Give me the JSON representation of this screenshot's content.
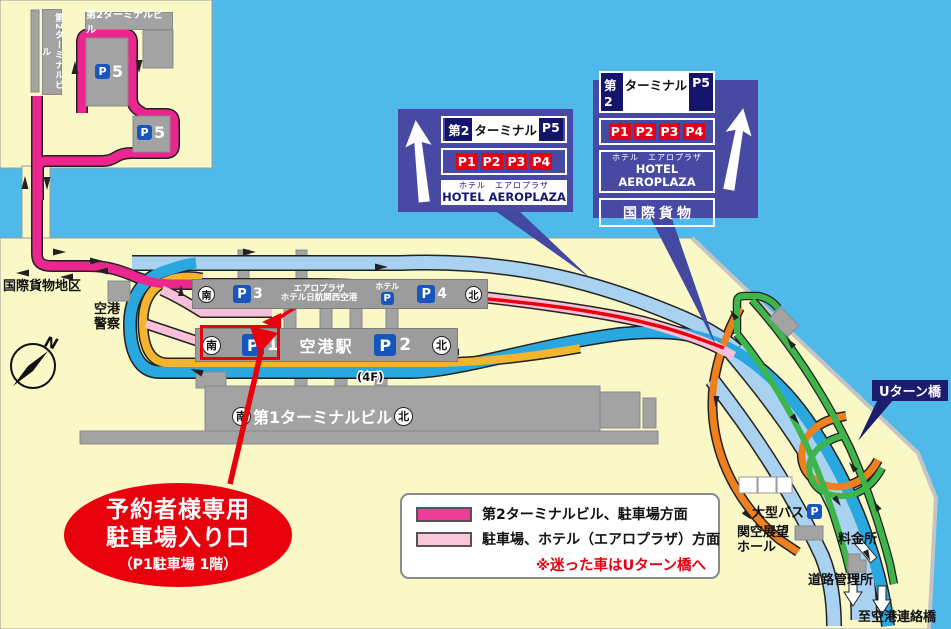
{
  "colors": {
    "water": "#4FB9E9",
    "land": "#FBF8C8",
    "building_gray": "#A3A3A3",
    "route_terminal2_magenta": "#EC268F",
    "route_parking_hotel_pink": "#F8C0D8",
    "road_blue": "#29A7DF",
    "road_pale_blue": "#A8D2F0",
    "road_yellow": "#F2B52D",
    "road_orange": "#F07F1E",
    "road_green": "#3DB54A",
    "reserved_red": "#E8000D",
    "sign_background": "#4749A3",
    "sign_navy": "#14146B",
    "sign_red": "#E60012",
    "p_icon_blue": "#1656BE",
    "uturn_label_bg": "#1D1D6E"
  },
  "terminal2_area": {
    "vertical_building_label": "第2ターミナルビル",
    "building_label": "第2ターミナルビル",
    "p_letter": "P",
    "p5_number": "5"
  },
  "signs": {
    "left": {
      "line1": [
        "第2",
        "ターミナル",
        "P5"
      ],
      "line2": [
        "P1",
        "P2",
        "P3",
        "P4"
      ],
      "hotel_jp": "ホテル　エアロプラザ",
      "hotel_en": "HOTEL AEROPLAZA"
    },
    "right": {
      "line1": [
        "第2",
        "ターミナル",
        "P5"
      ],
      "line2": [
        "P1",
        "P2",
        "P3",
        "P4"
      ],
      "hotel_jp": "ホテル　エアロプラザ",
      "hotel_en": "HOTEL AEROPLAZA",
      "cargo": "国際貨物"
    }
  },
  "map": {
    "intl_cargo_area": "国際貨物地区",
    "airport_police_line1": "空港",
    "airport_police_line2": "警察",
    "compass_n": "N",
    "p_letter": "P",
    "top_bar": {
      "south": "南",
      "p3_number": "3",
      "aeroplaza_line1": "エアロプラザ",
      "aeroplaza_line2": "ホテル日航関西空港",
      "hotel": "ホテル",
      "p4_number": "4",
      "north": "北"
    },
    "station_bar": {
      "south": "南",
      "p1_number": "1",
      "station": "空港駅",
      "p2_number": "2",
      "north": "北"
    },
    "floor_label": "(4F)",
    "terminal1": {
      "south": "南",
      "label": "第1ターミナルビル",
      "north": "北"
    },
    "uturn_bridge": "Uターン橋",
    "large_bus": "大型バス",
    "viewing_hall_line1": "関空展望",
    "viewing_hall_line2": "ホール",
    "toll_gate": "料金所",
    "road_office": "道路管理所",
    "to_access_bridge": "至空港連絡橋"
  },
  "legend": {
    "item1": "第2ターミナルビル、駐車場方面",
    "item2": "駐車場、ホテル（エアロプラザ）方面",
    "note": "※迷った車はUターン橋へ"
  },
  "reserved_callout": {
    "line1": "予約者様専用",
    "line2": "駐車場入り口",
    "line3": "（P1駐車場 1階）"
  }
}
